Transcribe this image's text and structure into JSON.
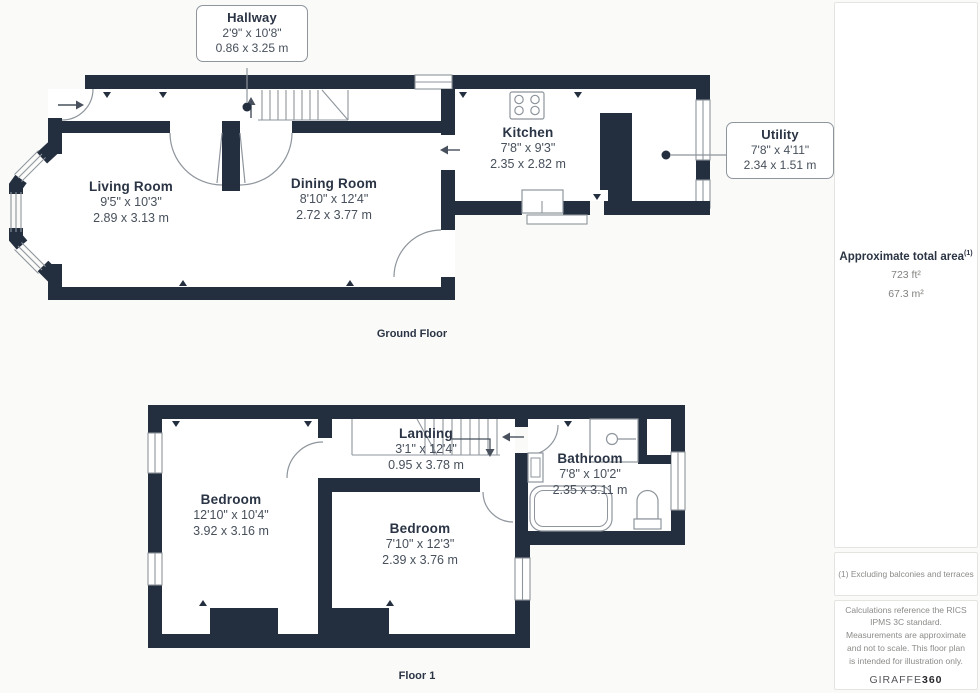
{
  "floors": [
    {
      "caption": "Ground Floor",
      "rooms": [
        {
          "name": "Living Room",
          "imperial": "9'5\" x 10'3\"",
          "metric": "2.89 x 3.13 m"
        },
        {
          "name": "Dining Room",
          "imperial": "8'10\" x 12'4\"",
          "metric": "2.72 x 3.77 m"
        },
        {
          "name": "Kitchen",
          "imperial": "7'8\" x 9'3\"",
          "metric": "2.35 x 2.82 m"
        }
      ],
      "callouts": [
        {
          "name": "Hallway",
          "imperial": "2'9\" x 10'8\"",
          "metric": "0.86 x 3.25 m"
        },
        {
          "name": "Utility",
          "imperial": "7'8\" x 4'11\"",
          "metric": "2.34 x 1.51 m"
        }
      ]
    },
    {
      "caption": "Floor 1",
      "rooms": [
        {
          "name": "Bedroom",
          "imperial": "12'10\" x 10'4\"",
          "metric": "3.92 x 3.16 m"
        },
        {
          "name": "Landing",
          "imperial": "3'1\" x 12'4\"",
          "metric": "0.95 x 3.78 m"
        },
        {
          "name": "Bathroom",
          "imperial": "7'8\" x 10'2\"",
          "metric": "2.35 x 3.11 m"
        },
        {
          "name": "Bedroom",
          "imperial": "7'10\" x 12'3\"",
          "metric": "2.39 x 3.76 m"
        }
      ]
    }
  ],
  "sidebar": {
    "area_title": "Approximate total area",
    "area_note_ref": "(1)",
    "area_ft": "723 ft²",
    "area_m": "67.3 m²",
    "footnote": "(1) Excluding balconies and terraces",
    "disclaimer": "Calculations reference the RICS IPMS 3C standard. Measurements are approximate and not to scale. This floor plan is intended for illustration only.",
    "brand": {
      "name": "GIRAFFE",
      "suffix": "360"
    }
  }
}
